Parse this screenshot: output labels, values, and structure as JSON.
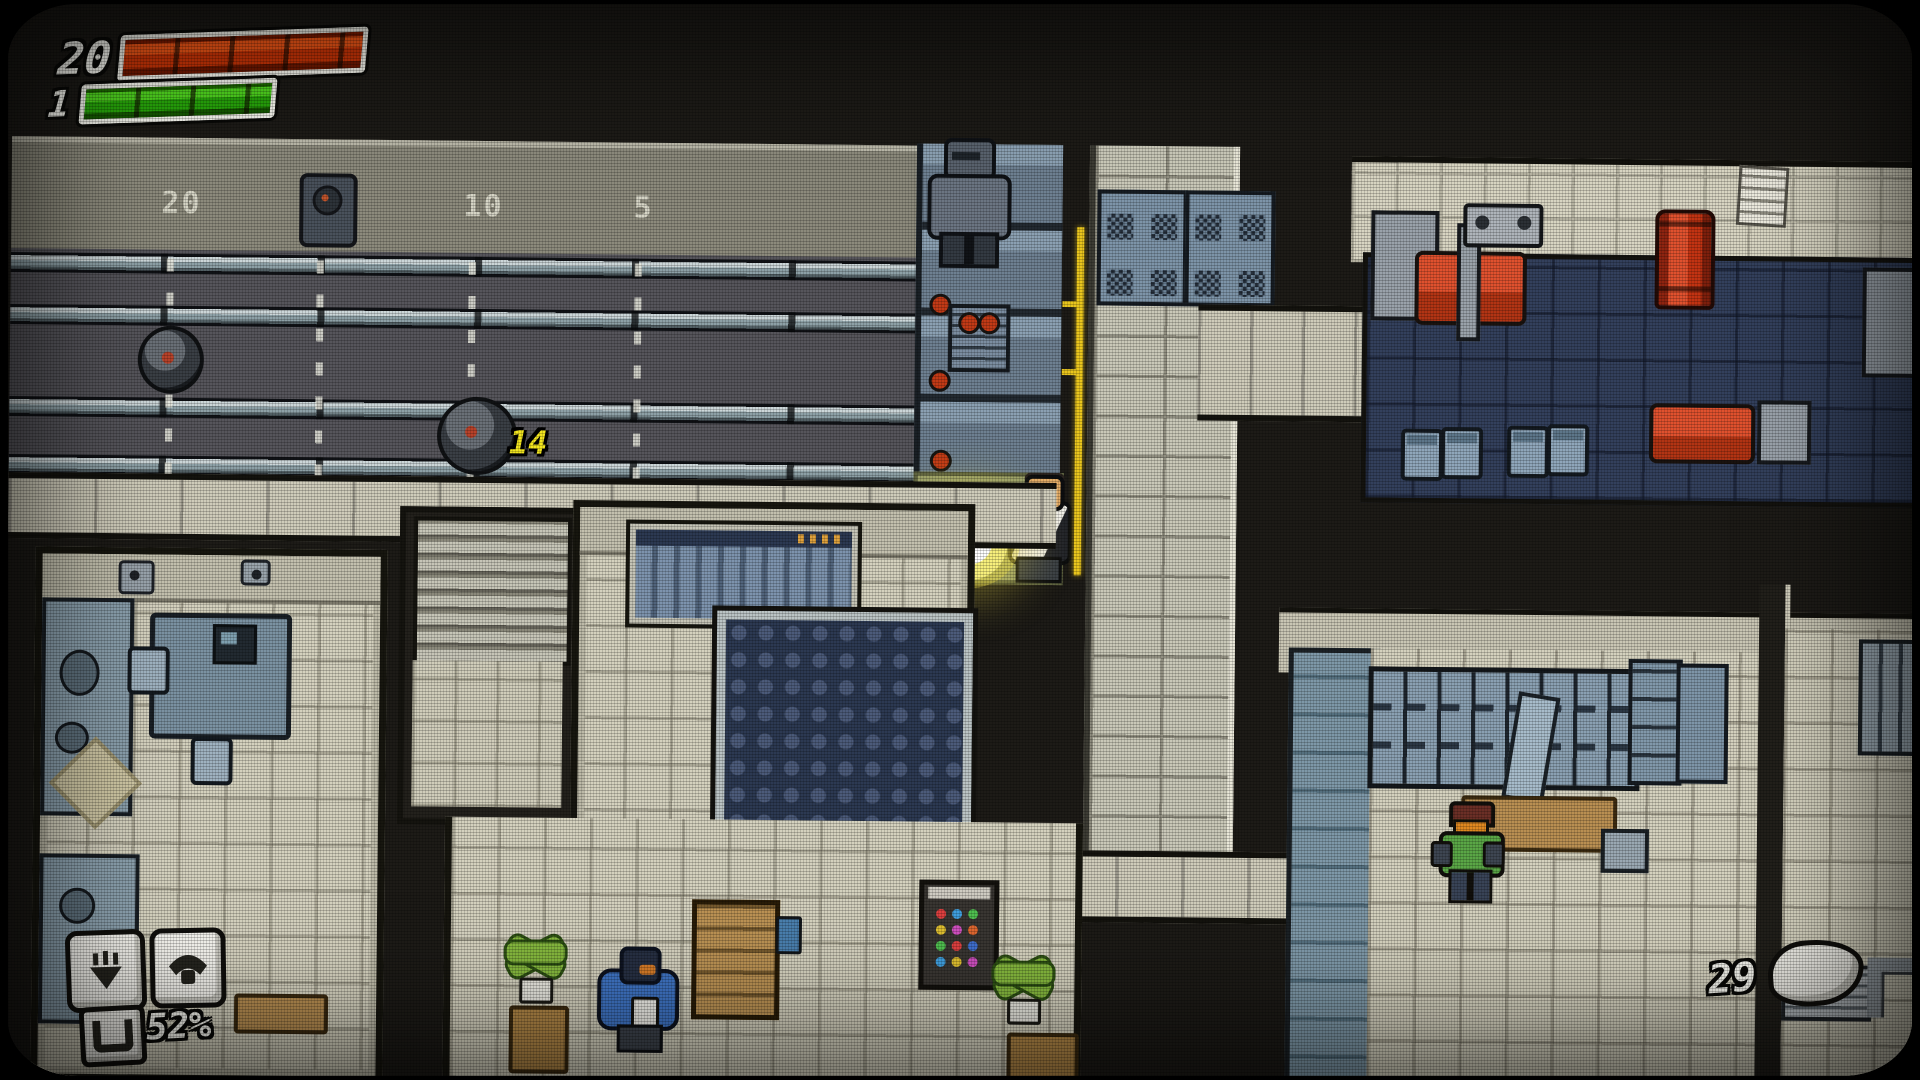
{
  "hud": {
    "health_bar": {
      "value": "20",
      "fill_color": "#c93407",
      "segments": 4
    },
    "energy_bar": {
      "value": "1",
      "fill_color": "#27a50a",
      "segments": 4
    },
    "slots": {
      "slot1_icon": "drop-item-icon",
      "slot2_icon": "phone-icon"
    },
    "ammo": {
      "icon": "magazine-icon",
      "percent": "52%"
    },
    "money": {
      "count": "29",
      "icon": "nugget-icon"
    }
  },
  "shooting_range": {
    "distance_markers": [
      "20",
      "15",
      "10",
      "5"
    ],
    "damage_popup": "14",
    "laser_color": "#e9c51d"
  },
  "colors": {
    "damage_yellow": "#f2e51f",
    "gym_floor_navy": "#33405c",
    "gym_red": "#e0512e",
    "brick_light": "#c9c8b8",
    "floor_beige": "#d4d1be",
    "range_floor_grey": "#56555b"
  }
}
